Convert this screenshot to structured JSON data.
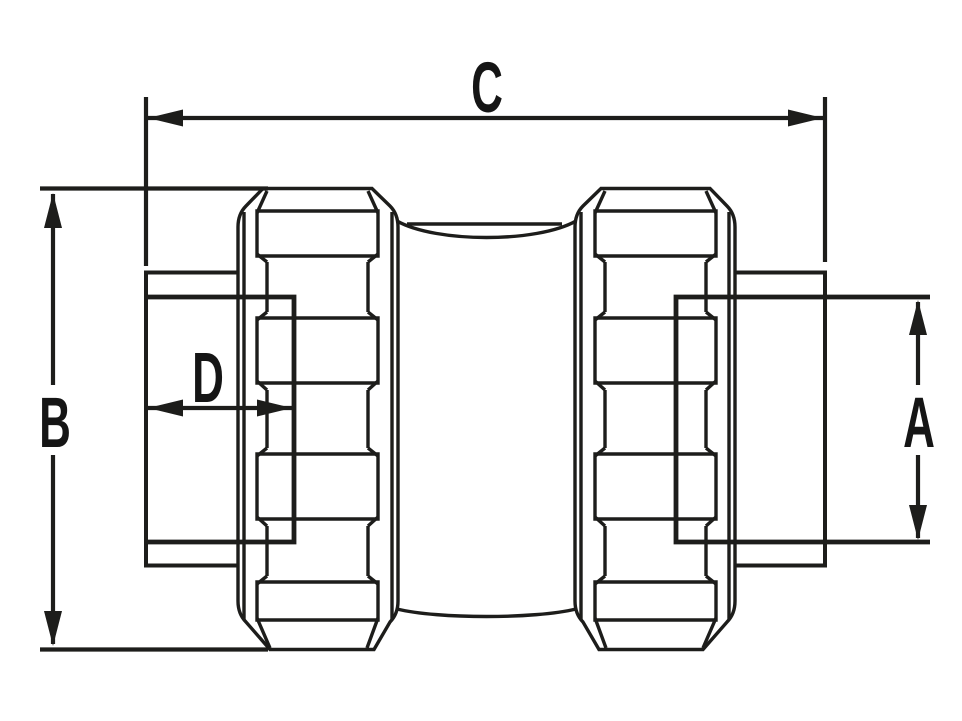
{
  "diagram": {
    "title": "Compression coupling fitting - dimensioned side view technical drawing",
    "background_color": "#ffffff",
    "line_color": "#1d1d1b",
    "label_color": "#151515",
    "labels": {
      "C": "C",
      "B": "B",
      "D": "D",
      "A": "A"
    },
    "dimension_meanings": {
      "C": "overall length (top horizontal dimension)",
      "B": "overall body height (left vertical dimension)",
      "D": "pipe insertion depth (inner horizontal dimension)",
      "A": "pipe outside diameter (right vertical dimension)"
    }
  }
}
